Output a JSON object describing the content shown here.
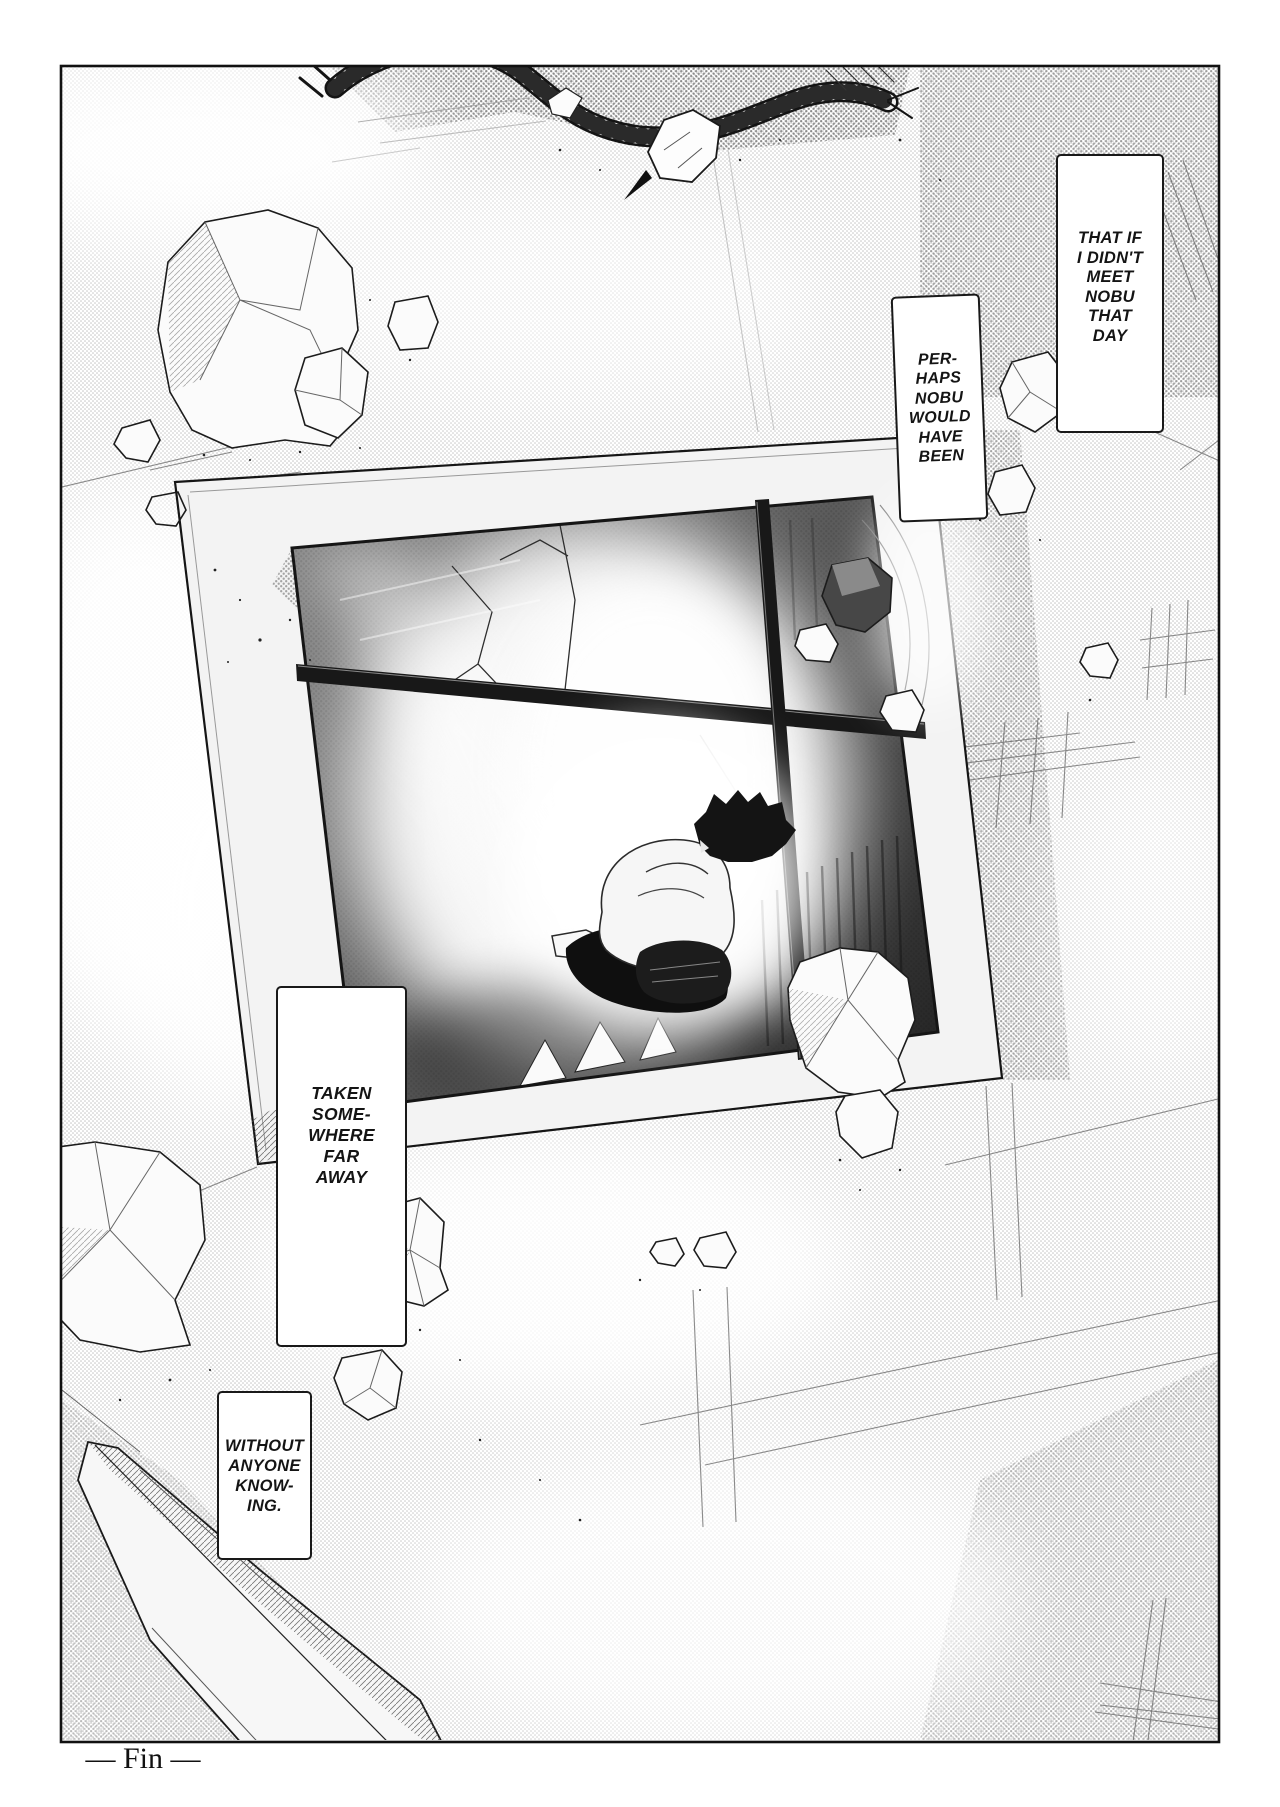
{
  "page": {
    "kind": "manga page, single full-page panel",
    "fin_label": "— Fin —"
  },
  "colors": {
    "ink": "#1a1a1a",
    "paper": "#ffffff",
    "halftone_gray": "#8a8a8a"
  },
  "bubbles": [
    {
      "id": "that-day",
      "text": "THAT IF\nI DIDN'T\nMEET\nNOBU\nTHAT\nDAY"
    },
    {
      "id": "perhaps",
      "text": "PER-\nHAPS\nNOBU\nWOULD\nHAVE\nBEEN"
    },
    {
      "id": "taken",
      "text": "TAKEN\nSOME-\nWHERE\nFAR\nAWAY"
    },
    {
      "id": "without",
      "text": "WITHOUT\nANYONE\nKNOW-\nING."
    }
  ]
}
